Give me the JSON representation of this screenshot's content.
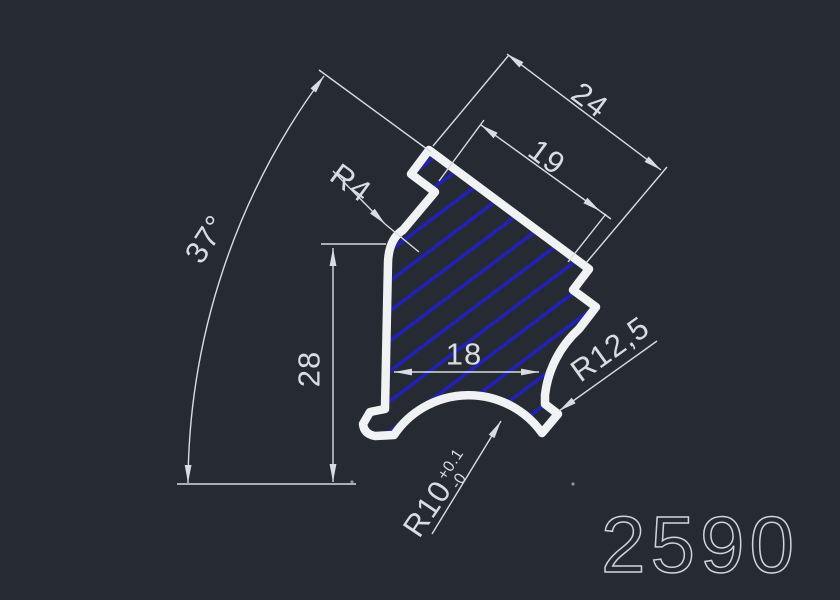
{
  "drawing": {
    "part_number": "2590",
    "dimensions": {
      "cap_width": "24",
      "slot_width": "19",
      "corner_radius": "R4",
      "tilt_angle": "37°",
      "body_height": "28",
      "body_width": "18",
      "side_radius": "R12,5",
      "bottom_radius": "R10",
      "bottom_radius_tol_upper": "+0.1",
      "bottom_radius_tol_lower": "-0"
    },
    "colors": {
      "background": "#252a33",
      "profile_outline": "#f0f2f4",
      "hatch": "#2121b8",
      "dimension_lines": "#d9dce0"
    }
  }
}
